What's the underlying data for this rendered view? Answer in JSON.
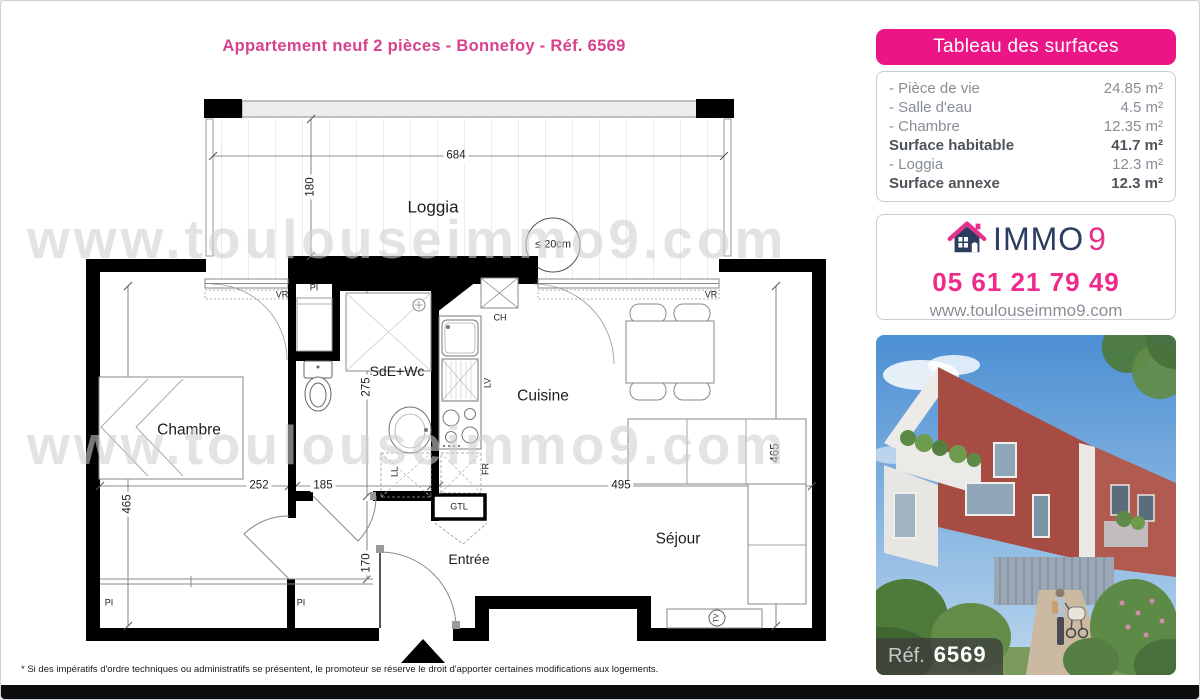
{
  "title": "Appartement neuf 2 pièces - Bonnefoy - Réf. 6569",
  "watermark": {
    "line1": "www.toulouseimmo9.com",
    "line2": "www.toulouseimmo9.com"
  },
  "surfaces": {
    "header": "Tableau des surfaces",
    "rows": [
      {
        "label": "- Pièce de vie",
        "value": "24.85 m²"
      },
      {
        "label": "- Salle d'eau",
        "value": "4.5 m²"
      },
      {
        "label": "- Chambre",
        "value": "12.35 m²"
      },
      {
        "label": "Surface habitable",
        "value": "41.7 m²"
      },
      {
        "label": "- Loggia",
        "value": "12.3 m²"
      },
      {
        "label": "Surface annexe",
        "value": "12.3 m²"
      }
    ]
  },
  "agency": {
    "brand_immo": "IMMO",
    "brand_9": "9",
    "phone": "05 61 21 79 49",
    "website": "www.toulouseimmo9.com"
  },
  "photo": {
    "ref_label": "Réf.",
    "ref_number": "6569"
  },
  "plan": {
    "rooms": {
      "loggia": "Loggia",
      "chambre": "Chambre",
      "sde": "SdE+Wc",
      "cuisine": "Cuisine",
      "sejour": "Séjour",
      "entree": "Entrée"
    },
    "dims": {
      "d684": "684",
      "d180": "180",
      "d252": "252",
      "d185": "185",
      "d495": "495",
      "d465_left": "465",
      "d465_right": "465",
      "d275": "275",
      "d170": "170"
    },
    "labels": {
      "vr_left": "VR",
      "vr_right": "VR",
      "pi_top": "PI",
      "pi_left": "PI",
      "pi_mid": "PI",
      "ch": "CH",
      "lv": "LV",
      "fr": "FR",
      "ll": "LL",
      "gtl": "GTL",
      "tv": "TV",
      "height_note": "≤ 20cm"
    }
  },
  "footnote": "* Si des impératifs d'ordre techniques ou administratifs se présentent, le promoteur se réserve le droit d'apporter certaines modifications aux logements.",
  "colors": {
    "pink": "#ec1587",
    "navy": "#2b3c5e",
    "gray_text": "#8a9097"
  }
}
